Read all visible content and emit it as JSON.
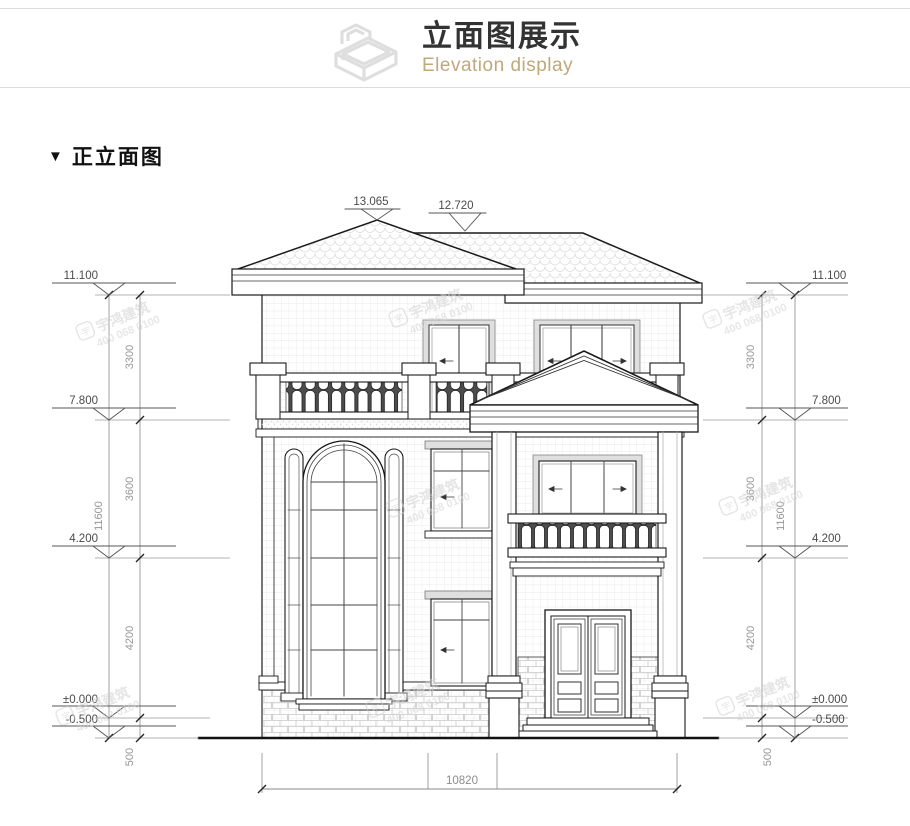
{
  "header": {
    "title": "立面图展示",
    "subtitle": "Elevation display"
  },
  "section": {
    "bullet": "▼",
    "title": "正立面图"
  },
  "watermark": {
    "brand": "宇鸿建筑",
    "phone": "400 068 0100",
    "logo": "宇"
  },
  "colors": {
    "subtitle_accent": "#bfa87b",
    "drawing_line": "#1a1a1a",
    "dimension_text": "#8c8c8c",
    "watermark": "#d0d0d0"
  },
  "drawing": {
    "dim_top": [
      "13.065",
      "12.720"
    ],
    "dim_levels": [
      "11.100",
      "7.800",
      "4.200",
      "±0.000",
      "-0.500"
    ],
    "dim_heights": [
      "3300",
      "3600",
      "4200",
      "500"
    ],
    "dim_total_height": "11600",
    "dim_total_width": "10820"
  }
}
